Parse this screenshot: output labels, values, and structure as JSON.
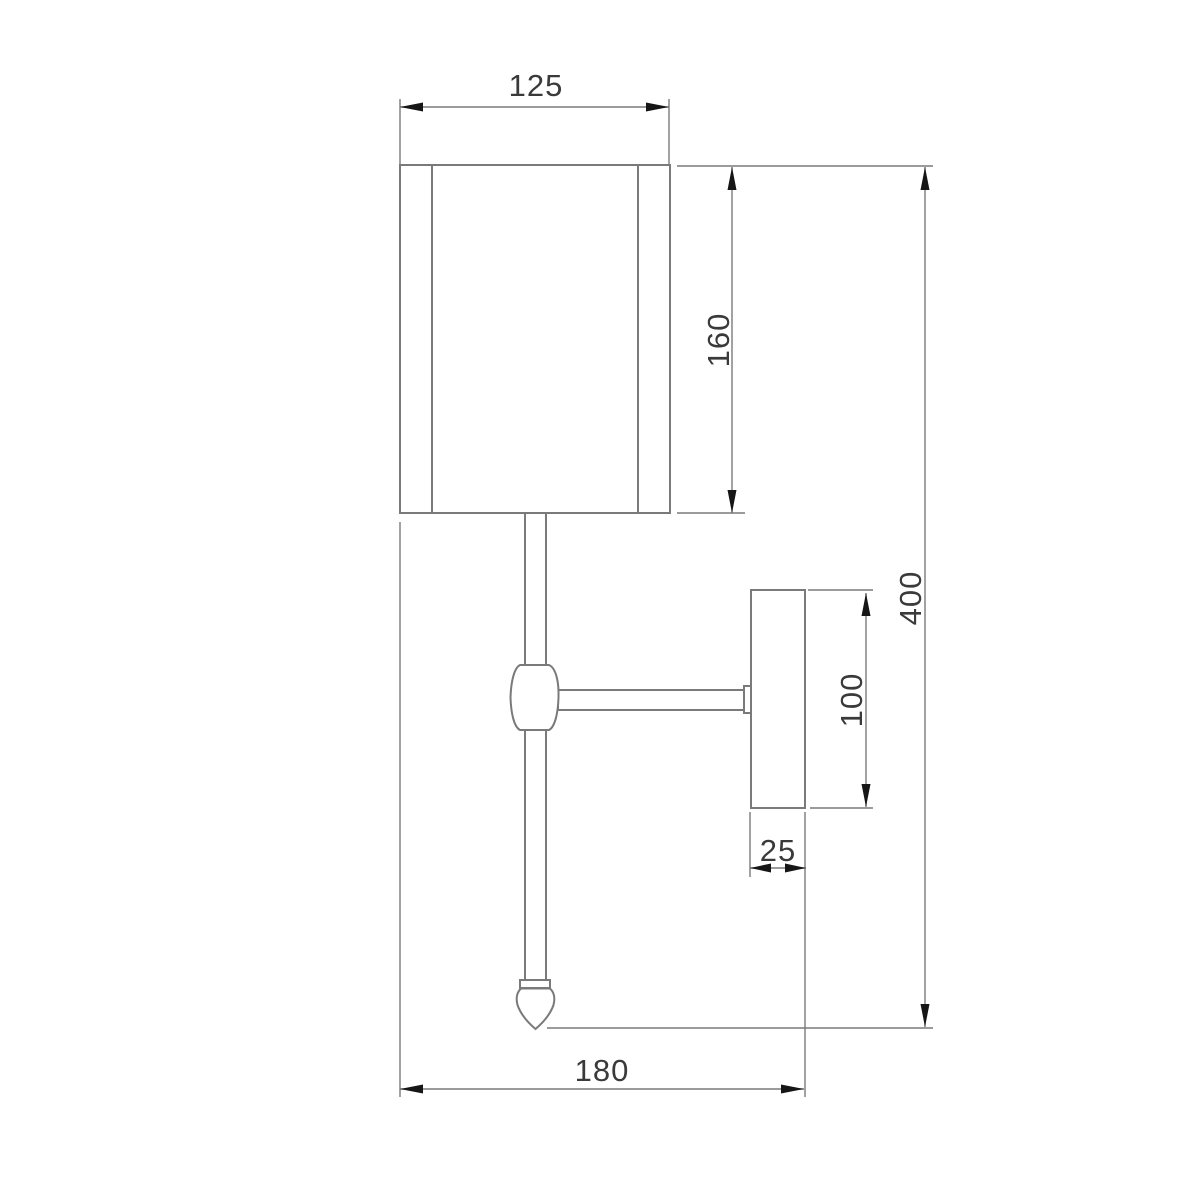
{
  "drawing": {
    "title": "wall-sconce-technical-drawing-side-view",
    "colors": {
      "background": "#ffffff",
      "line": "#7a7a7a",
      "arrow": "#161616",
      "text": "#3a3a3a"
    },
    "dimensions": {
      "shade_width": "125",
      "shade_height": "160",
      "total_height": "400",
      "backplate_height": "100",
      "backplate_depth": "25",
      "overall_depth": "180"
    }
  }
}
